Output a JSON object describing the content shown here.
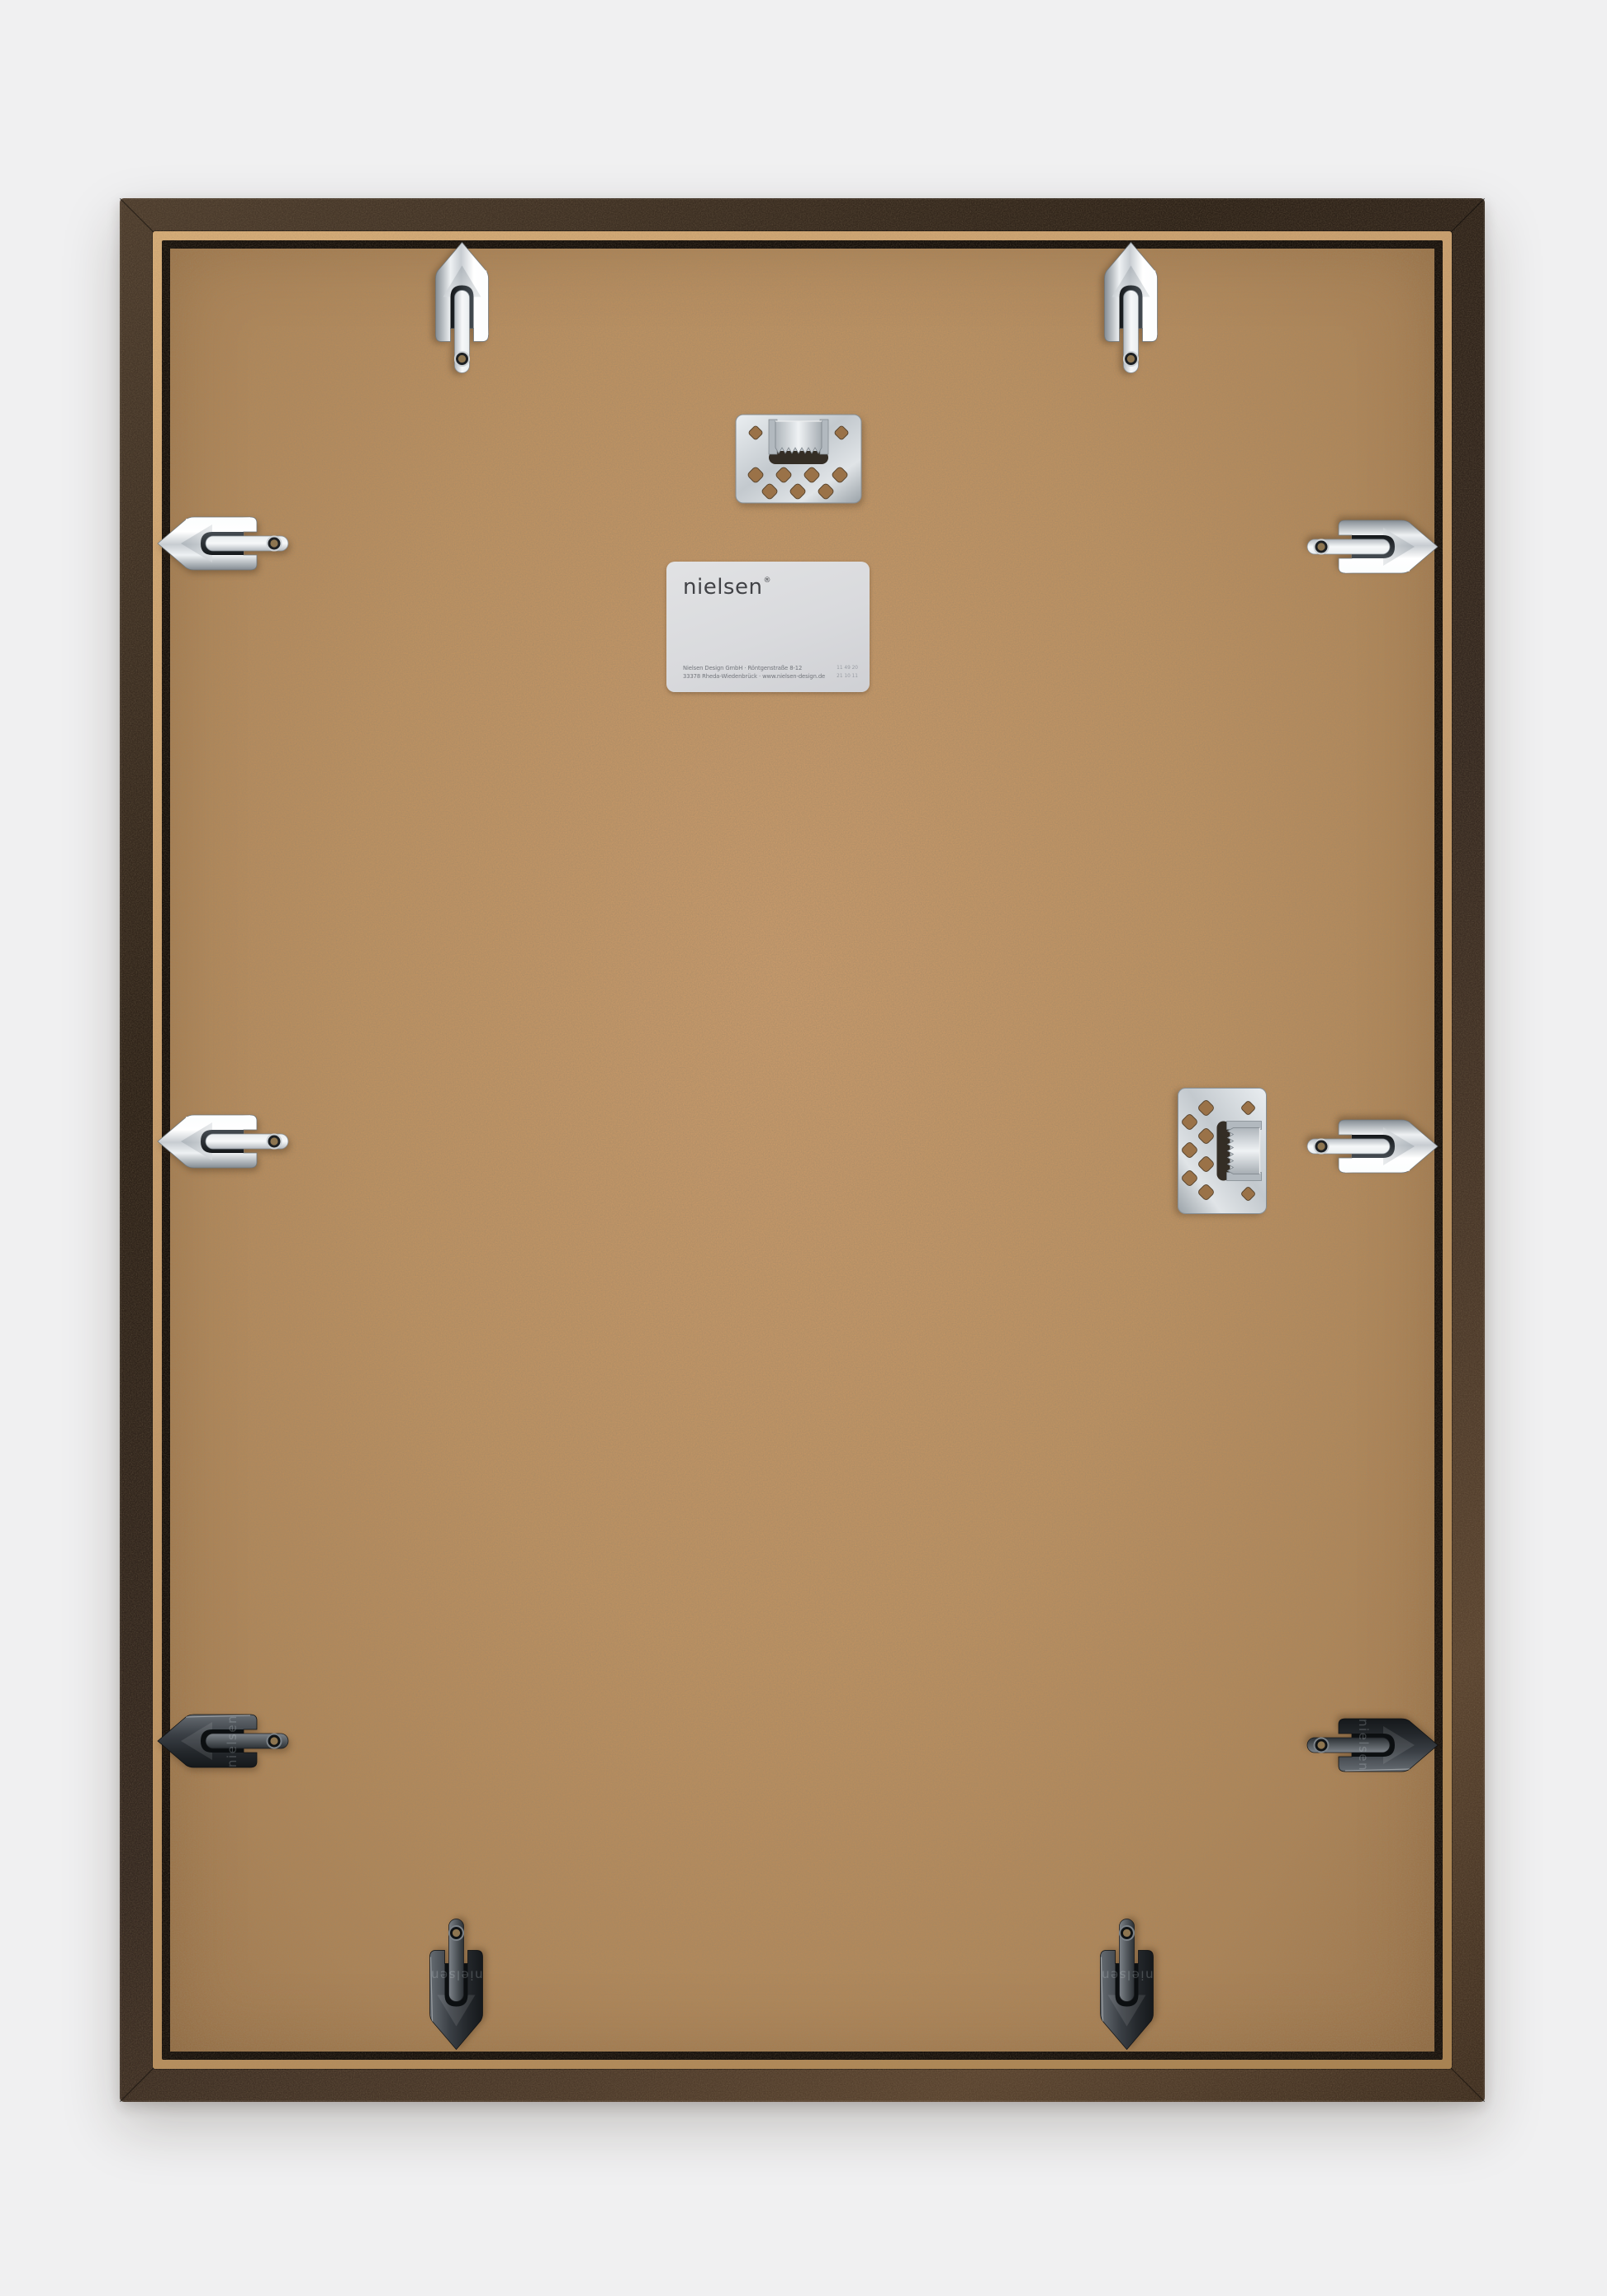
{
  "colors": {
    "bg": "#f0f0f1",
    "frame-dark": "#2d2218",
    "frame-copper": "#5a4430",
    "rim-tan": "#c49a6a",
    "gap-dark": "#17110c",
    "board-light": "#c89a6b",
    "board-mid": "#bd9161",
    "board-dark": "#9c744a",
    "chrome-bright": "#f4f7f9",
    "chrome-shadow": "#848c93",
    "label-bg": "#d9dadd"
  },
  "label": {
    "brand": "nielsen",
    "trademark": "®",
    "address_line_1": "Nielsen Design GmbH · Röntgenstraße 8-12",
    "address_line_2": "33378 Rheda-Wiedenbrück · www.nielsen-design.de",
    "code_line_1": "11 49 20",
    "code_line_2": "21 10 11"
  },
  "hardware": {
    "embossed_brand": "nielsen",
    "flex_clip_count": 10,
    "sawtooth_hanger_count": 2
  }
}
